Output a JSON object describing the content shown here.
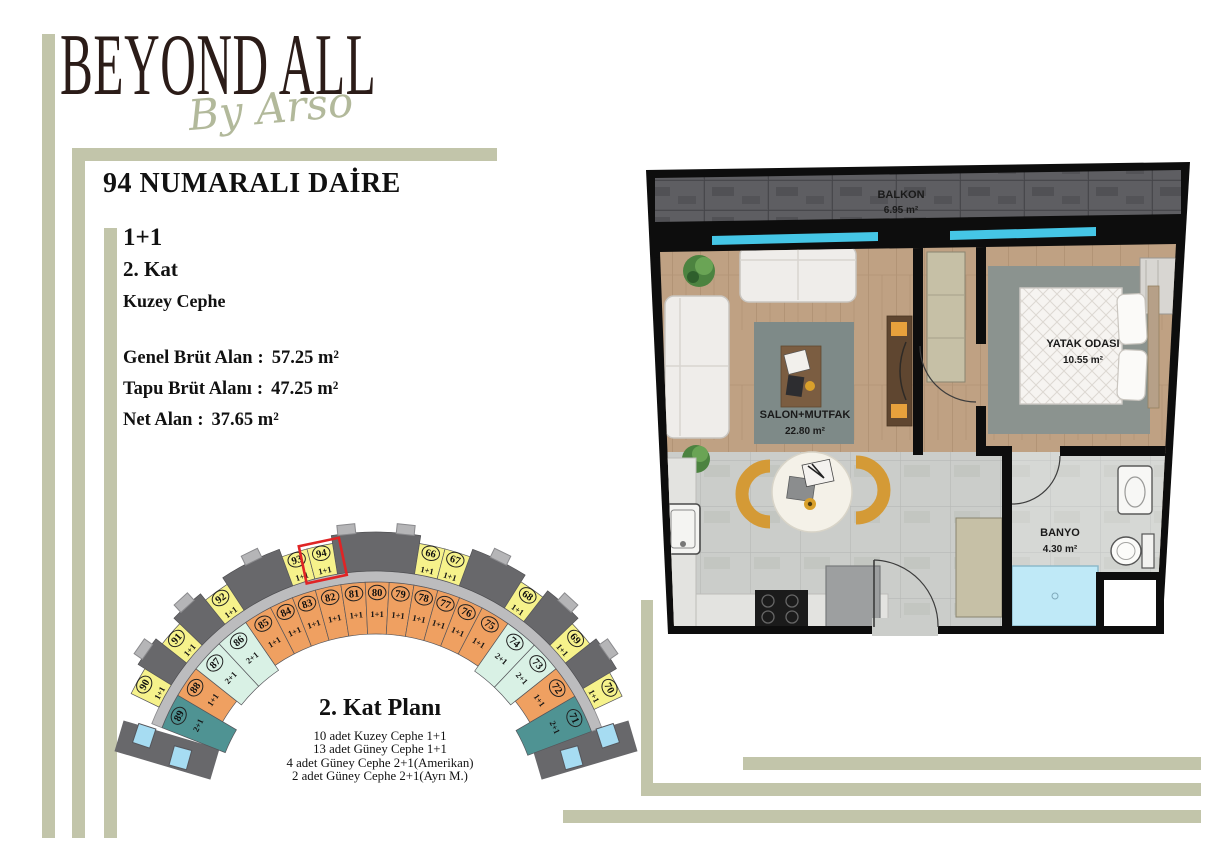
{
  "brand": {
    "name": "BEYOND ALL",
    "tagline": "By Arso"
  },
  "apartment": {
    "title": "94 NUMARALI DAİRE",
    "type": "1+1",
    "floor": "2. Kat",
    "facade": "Kuzey Cephe",
    "sep": ":",
    "areas": [
      {
        "label": "Genel Brüt Alan",
        "value": "57.25 m²"
      },
      {
        "label": "Tapu Brüt Alanı",
        "value": "47.25 m²"
      },
      {
        "label": "Net Alan",
        "value": "37.65 m²"
      }
    ]
  },
  "floor_plan": {
    "rooms": [
      {
        "name": "BALKON",
        "area": "6.95 m²"
      },
      {
        "name": "SALON+MUTFAK",
        "area": "22.80 m²"
      },
      {
        "name": "YATAK ODASI",
        "area": "10.55 m²"
      },
      {
        "name": "BANYO",
        "area": "4.30 m²"
      }
    ]
  },
  "site_plan": {
    "title": "2. Kat Planı",
    "legend": [
      "10 adet Kuzey Cephe 1+1",
      "13 adet Güney Cephe 1+1",
      "4 adet Güney Cephe 2+1(Amerikan)",
      "2 adet Güney Cephe 2+1(Ayrı M.)"
    ],
    "highlighted_unit": "94",
    "colors": {
      "kuzey": "#f6f28b",
      "guney11": "#efa061",
      "amerikan": "#d9f1e5",
      "ayri": "#4f9393",
      "block_dark": "#68686b",
      "corridor": "#bcbcbe",
      "tab": "#b5b5b7",
      "blue_box": "#a6dcf2",
      "highlight": "#e02425"
    },
    "geometry": {
      "cx": 376,
      "cy": 812
    },
    "inner_units": [
      {
        "no": "89",
        "type": "2+1",
        "cat": "ayri",
        "a0": -68.5,
        "a1": -59.5
      },
      {
        "no": "88",
        "type": "1+1",
        "cat": "guney11",
        "a0": -59.5,
        "a1": -51.5
      },
      {
        "no": "87",
        "type": "2+1",
        "cat": "amerikan",
        "a0": -51.5,
        "a1": -43.0
      },
      {
        "no": "86",
        "type": "2+1",
        "cat": "amerikan",
        "a0": -43.0,
        "a1": -34.5
      },
      {
        "no": "85",
        "type": "1+1",
        "cat": "guney11",
        "a0": -34.5,
        "a1": -27.3
      },
      {
        "no": "84",
        "type": "1+1",
        "cat": "guney11",
        "a0": -27.3,
        "a1": -21.3
      },
      {
        "no": "83",
        "type": "1+1",
        "cat": "guney11",
        "a0": -21.3,
        "a1": -15.3
      },
      {
        "no": "82",
        "type": "1+1",
        "cat": "guney11",
        "a0": -15.3,
        "a1": -8.8
      },
      {
        "no": "81",
        "type": "1+1",
        "cat": "guney11",
        "a0": -8.8,
        "a1": -2.7
      },
      {
        "no": "80",
        "type": "1+1",
        "cat": "guney11",
        "a0": -2.7,
        "a1": 3.3
      },
      {
        "no": "79",
        "type": "1+1",
        "cat": "guney11",
        "a0": 3.3,
        "a1": 9.5
      },
      {
        "no": "78",
        "type": "1+1",
        "cat": "guney11",
        "a0": 9.5,
        "a1": 15.6
      },
      {
        "no": "77",
        "type": "1+1",
        "cat": "guney11",
        "a0": 15.6,
        "a1": 21.3
      },
      {
        "no": "76",
        "type": "1+1",
        "cat": "guney11",
        "a0": 21.3,
        "a1": 27.5
      },
      {
        "no": "75",
        "type": "1+1",
        "cat": "guney11",
        "a0": 27.5,
        "a1": 35.0
      },
      {
        "no": "74",
        "type": "2+1",
        "cat": "amerikan",
        "a0": 35.0,
        "a1": 43.5
      },
      {
        "no": "73",
        "type": "2+1",
        "cat": "amerikan",
        "a0": 43.5,
        "a1": 51.5
      },
      {
        "no": "72",
        "type": "1+1",
        "cat": "guney11",
        "a0": 51.5,
        "a1": 59.8
      },
      {
        "no": "71",
        "type": "2+1",
        "cat": "ayri",
        "a0": 59.8,
        "a1": 69.5
      }
    ],
    "outer_units": [
      {
        "no": "90",
        "type": "1+1",
        "a0": -64.2,
        "a1": -58.2
      },
      {
        "no": "91",
        "type": "1+1",
        "a0": -51.8,
        "a1": -46.2
      },
      {
        "no": "92",
        "type": "1+1",
        "a0": -38.8,
        "a1": -33.2
      },
      {
        "no": "93",
        "type": "1+1",
        "a0": -20.2,
        "a1": -14.7
      },
      {
        "no": "94",
        "type": "1+1",
        "a0": -14.7,
        "a1": -9.2,
        "highlight": true
      },
      {
        "no": "66",
        "type": "1+1",
        "a0": 9.2,
        "a1": 14.7
      },
      {
        "no": "67",
        "type": "1+1",
        "a0": 14.7,
        "a1": 20.2
      },
      {
        "no": "68",
        "type": "1+1",
        "a0": 32.2,
        "a1": 37.8
      },
      {
        "no": "69",
        "type": "1+1",
        "a0": 46.2,
        "a1": 51.8
      },
      {
        "no": "70",
        "type": "1+1",
        "a0": 59.2,
        "a1": 64.8
      }
    ],
    "gray_blocks": [
      [
        -58.2,
        -51.8
      ],
      [
        -46.2,
        -38.8
      ],
      [
        -33.2,
        -20.2
      ],
      [
        -9.2,
        9.2
      ],
      [
        20.2,
        32.2
      ],
      [
        37.8,
        46.2
      ],
      [
        51.8,
        59.2
      ]
    ],
    "tabs": [
      -55,
      -42.5,
      -26,
      -6,
      6,
      26,
      42.5,
      55
    ]
  },
  "colors": {
    "sage_accent": "#c2c5aa",
    "logo_dark": "#2b1c18",
    "script_sage": "#b2b99b",
    "window_cyan": "#45c6e6"
  }
}
